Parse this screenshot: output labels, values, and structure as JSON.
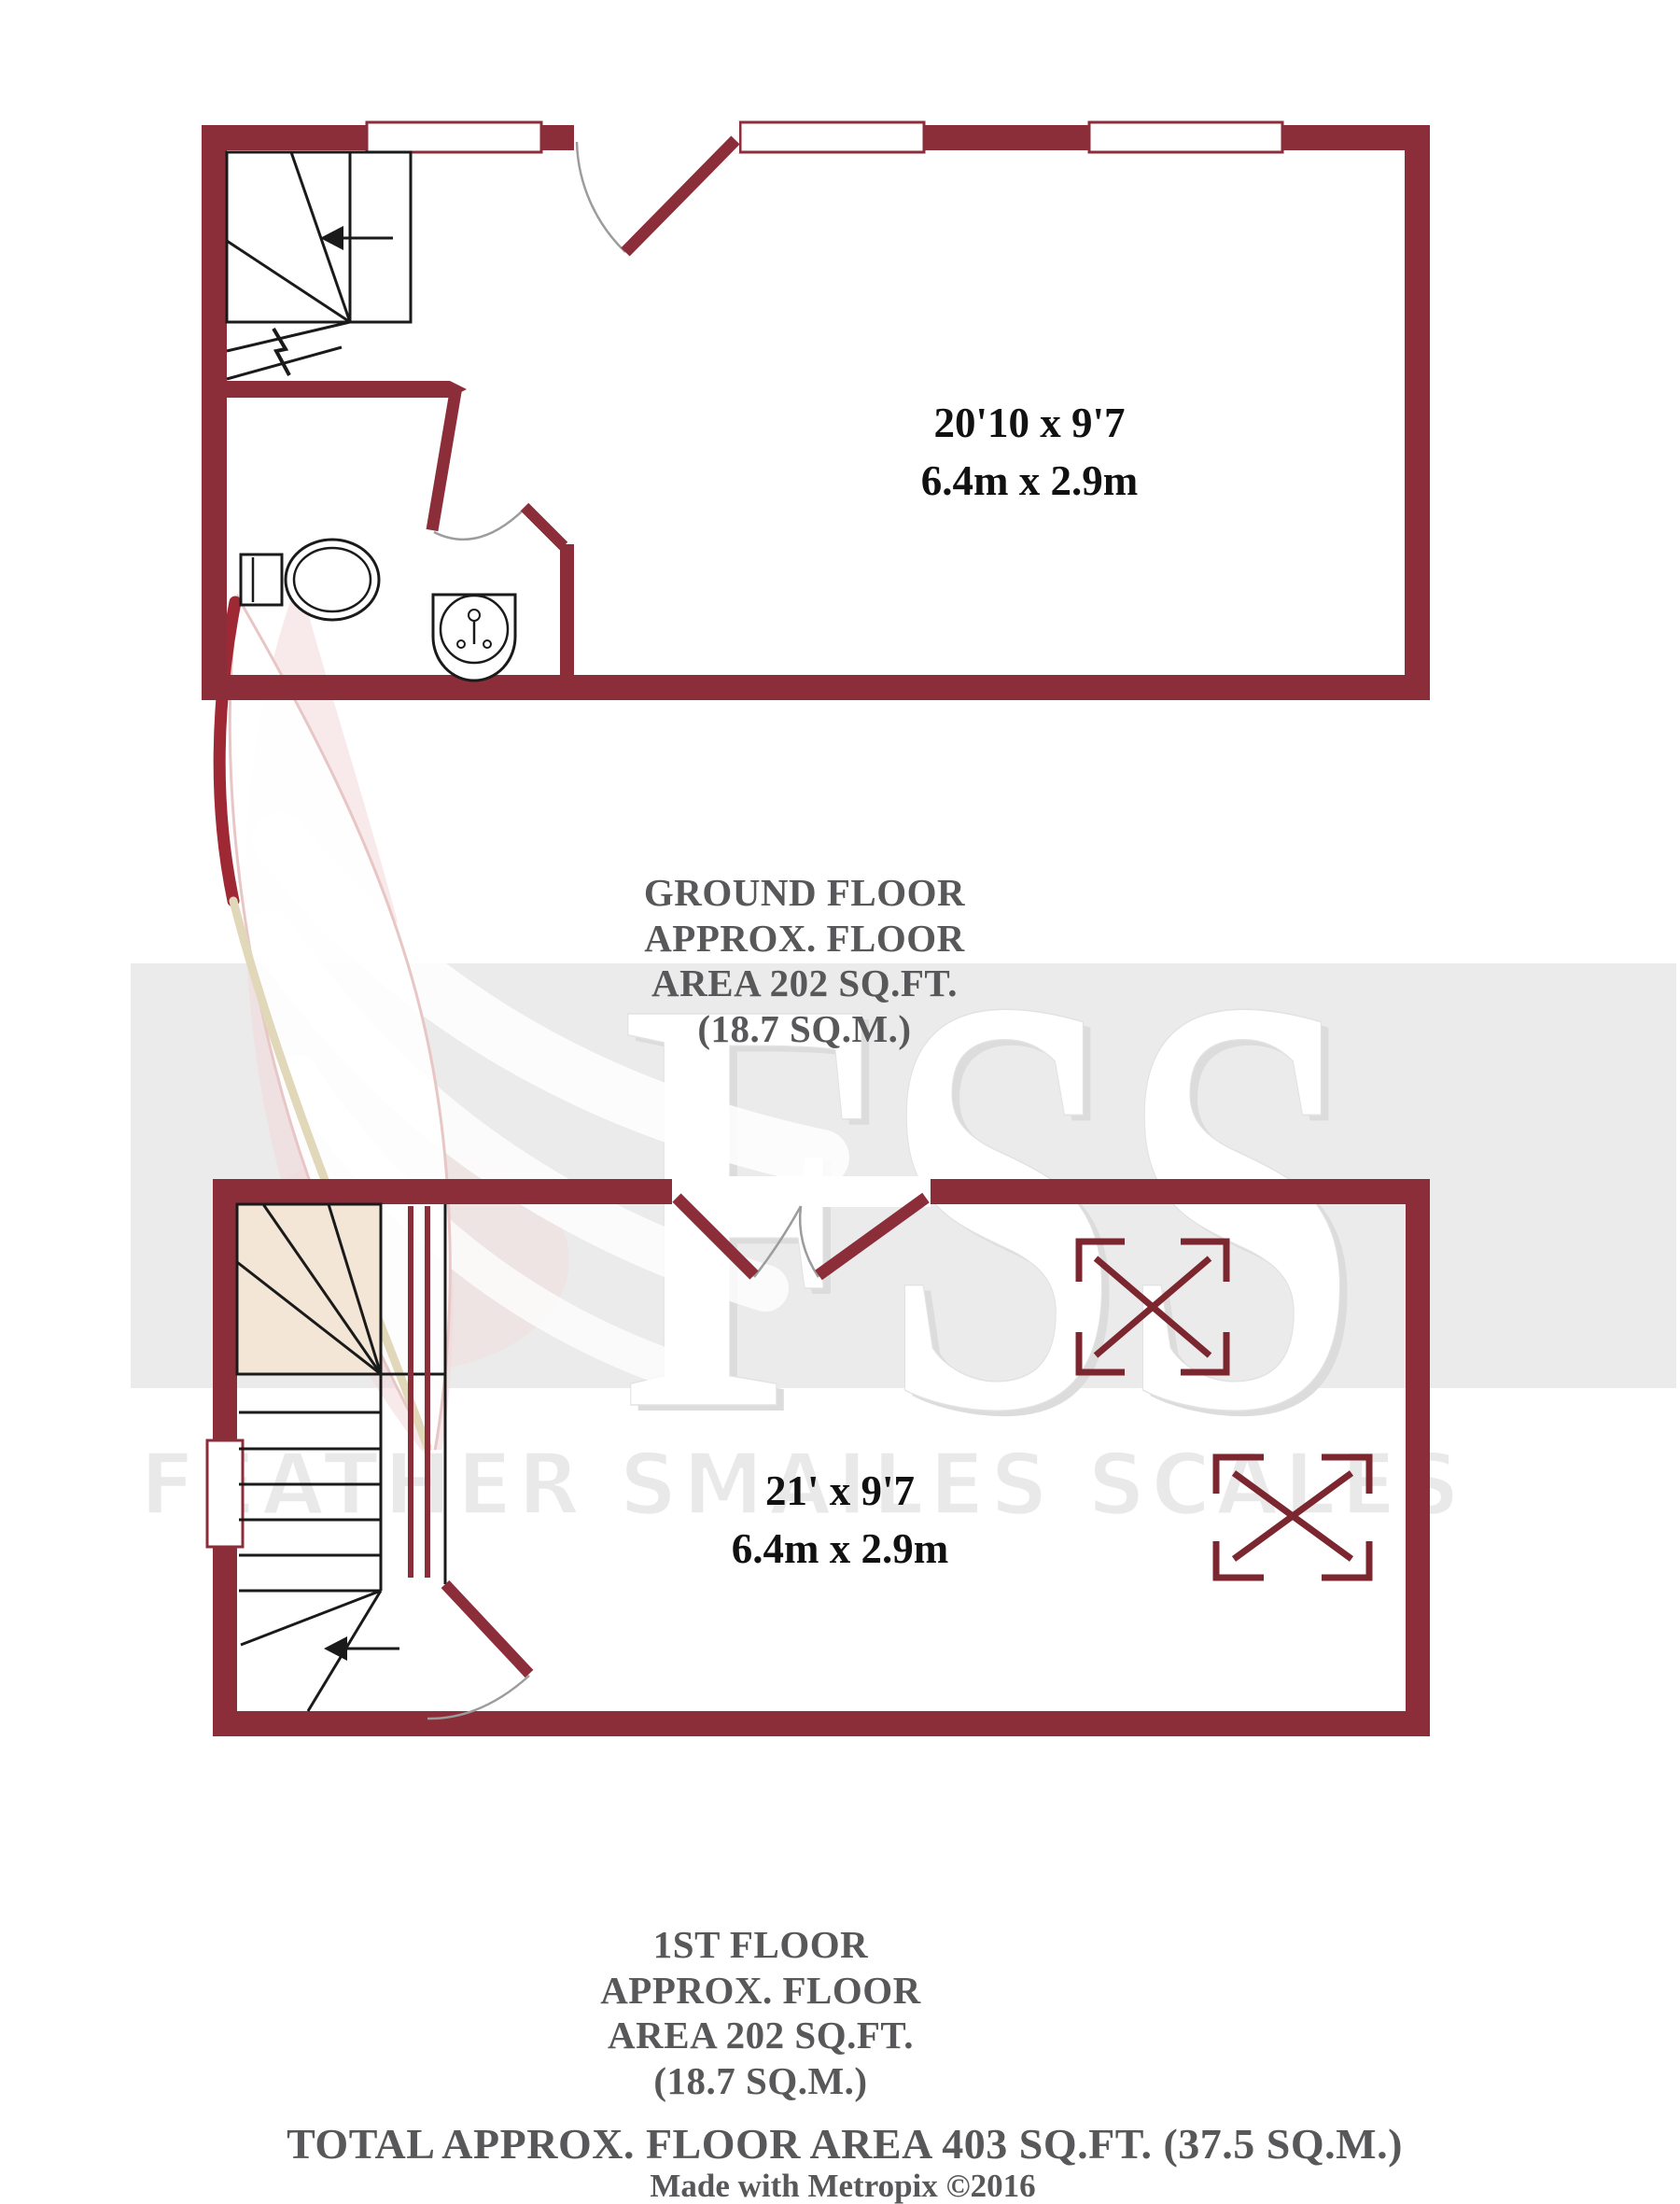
{
  "colors": {
    "wall": "#8C2E3A",
    "wall_dark": "#7C2630",
    "plan_line": "#1A1A1A",
    "arc": "#9C9C9C",
    "stair_winder_fill": "#F3E6D6",
    "label_text": "#58585A",
    "dimension_text": "#111111",
    "watermark_band": "#EBEBEB",
    "watermark_letters": "#FFFFFF",
    "watermark_name_fill": "#E9E9E9",
    "feather_red": "#9E2834",
    "feather_tan": "#E0D8B8"
  },
  "ground_floor": {
    "dimensions_imperial": "20'10 x 9'7",
    "dimensions_metric": "6.4m x 2.9m",
    "label_lines": [
      "GROUND FLOOR",
      "APPROX. FLOOR",
      "AREA 202 SQ.FT.",
      "(18.7 SQ.M.)"
    ]
  },
  "first_floor": {
    "dimensions_imperial": "21' x 9'7",
    "dimensions_metric": "6.4m x 2.9m",
    "label_lines": [
      "1ST FLOOR",
      "APPROX. FLOOR",
      "AREA 202 SQ.FT.",
      "(18.7 SQ.M.)"
    ]
  },
  "summary": {
    "total_area": "TOTAL APPROX. FLOOR AREA 403 SQ.FT. (37.5 SQ.M.)",
    "credit": "Made with Metropix ©2016"
  },
  "watermark": {
    "monogram": "FSS",
    "name": "FEATHER SMAILES SCALES"
  }
}
